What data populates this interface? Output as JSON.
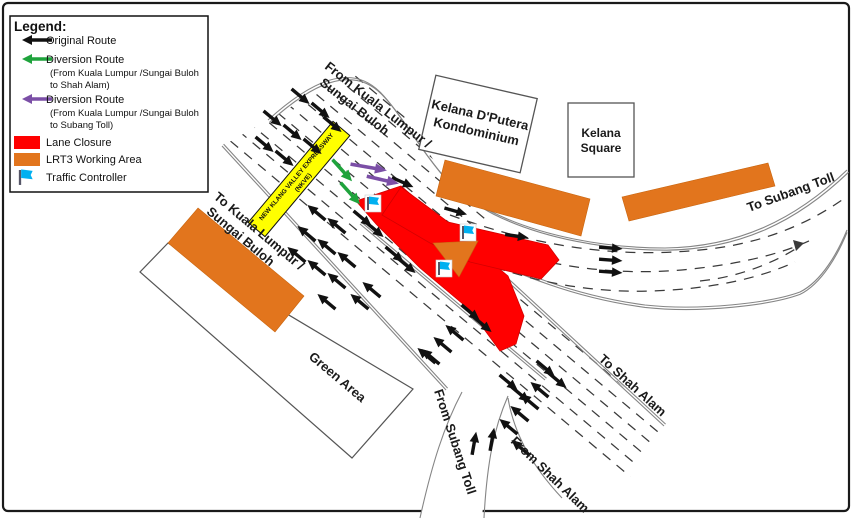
{
  "legend": {
    "title": "Legend:",
    "original": {
      "label": "Original Route"
    },
    "div_shah": {
      "label": "Diversion Route",
      "sub1": "(From Kuala Lumpur /Sungai Buloh",
      "sub2": "to Shah Alam)"
    },
    "div_subang": {
      "label": "Diversion Route",
      "sub1": "(From Kuala Lumpur /Sungai Buloh",
      "sub2": "to Subang Toll)"
    },
    "lane_closure": {
      "label": "Lane Closure"
    },
    "working_area": {
      "label": "LRT3 Working Area"
    },
    "traffic_controller": {
      "label": "Traffic Controller"
    }
  },
  "map": {
    "labels": {
      "from_kl_1": "From Kuala Lumpur /",
      "from_kl_2": "Sungai Buloh",
      "to_kl_1": "To Kuala Lumpur /",
      "to_kl_2": "Sungai Buloh",
      "to_subang": "To Subang Toll",
      "to_shah": "To Shah Alam",
      "from_shah": "From Shah Alam",
      "from_subang": "From Subang Toll",
      "green_area": "Green Area",
      "nkve_1": "NEW KLANG VALLEY EXPRESSWAY",
      "nkve_2": "(NKVE)"
    },
    "buildings": {
      "kelana_dputera_1": "Kelana D'Putera",
      "kelana_dputera_2": "Kondominium",
      "kelana_square_1": "Kelana",
      "kelana_square_2": "Square"
    }
  },
  "colors": {
    "lane_closure_red": "#FF0000",
    "working_area_orange": "#E2751D",
    "expressway_band_yellow": "#FFFF00",
    "diversion_green": "#1FA33C",
    "diversion_purple": "#7B4FA6",
    "traffic_controller_blue": "#00B0F0",
    "road_line_gray": "#858585",
    "arrow_black": "#111111"
  }
}
